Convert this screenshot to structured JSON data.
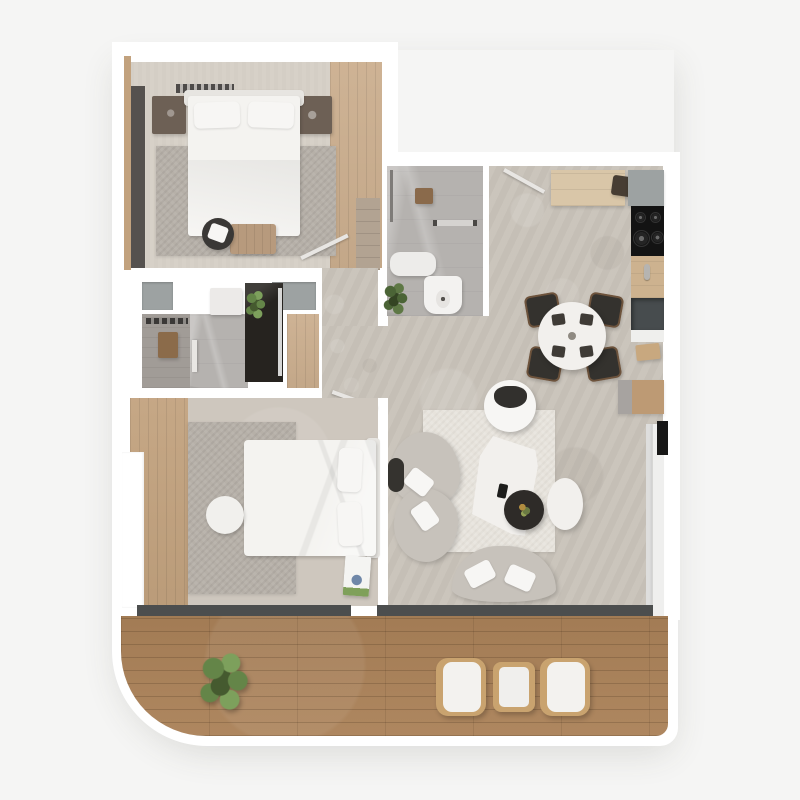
{
  "scene": {
    "title": "Two-bedroom apartment with balcony – 3D floor plan, top view",
    "style": "photoreal architectural render, no text labels"
  },
  "palette": {
    "bg": "#f5f5f4",
    "wall": "#ffffff",
    "concrete": "#c9c3ba",
    "carpet": "#d7d1c8",
    "rugGray": "#b6b0a8",
    "rugCream": "#e7e3dc",
    "woodCloset": "#cbae8e",
    "woodStrip": "#c2a27e",
    "deck": "#ab8259",
    "tileGray": "#b5b2af",
    "tileVanity": "#a19c97",
    "showerDark": "#26231f",
    "panelGray": "#9da2a2",
    "counterWood": "#d9c6a8",
    "counterWoodDark": "#cdb28f",
    "cooktop": "#131313",
    "sinkDark": "#474c4e",
    "applianceDark": "#473d33",
    "chairDark": "#34322e",
    "chairTrim": "#9c7049",
    "tableWhite": "#f2f0ed",
    "sofaGray": "#c7c2bb",
    "cushionWhite": "#f7f6f4",
    "sill": "#4c4e4e",
    "plantLight": "#7da05c",
    "plantMid": "#648548",
    "plantDark": "#455a2f",
    "towel": "#8b6b4a",
    "matBrown": "#8a6a4b",
    "wardrobe": "#55514e",
    "nightstand": "#6d6055",
    "bedWhite": "#f4f3f0",
    "headboard": "#e7e5e1",
    "doorLeaf": "#e8e6e3",
    "glass": "#ebebea",
    "black": "#171717",
    "tan": "#bd9a74"
  },
  "rooms": [
    {
      "id": "bedroom-1",
      "label": "Bedroom 1",
      "furniture": [
        "double-bed",
        "nightstand-left",
        "nightstand-right",
        "rug",
        "round-stool",
        "bench",
        "wardrobe",
        "radiator",
        "shelf-unit"
      ]
    },
    {
      "id": "bathroom-1",
      "label": "Bathroom 1",
      "furniture": [
        "walk-in-shower",
        "bath-mat",
        "towel-rail",
        "shower-tray",
        "toilet",
        "plant"
      ]
    },
    {
      "id": "bathroom-2",
      "label": "Bathroom 2",
      "furniture": [
        "vanity",
        "towel-rail",
        "towel",
        "sink-unit",
        "shower-cabin",
        "glass-screen",
        "plant",
        "wood-floor-nook"
      ]
    },
    {
      "id": "hallway",
      "label": "Hallway",
      "furniture": [
        "door-to-bedroom-1",
        "door-to-bedroom-2",
        "bathroom-door"
      ]
    },
    {
      "id": "kitchen",
      "label": "Kitchen",
      "furniture": [
        "top-counter",
        "small-appliance",
        "corner-cabinet",
        "cooktop",
        "counter",
        "faucet",
        "sink",
        "base-cabinet",
        "stool"
      ]
    },
    {
      "id": "dining-area",
      "label": "Dining area",
      "furniture": [
        "round-table",
        "chair-nw",
        "chair-ne",
        "chair-sw",
        "chair-se",
        "entry-door"
      ]
    },
    {
      "id": "living-room",
      "label": "Living room",
      "furniture": [
        "armchair",
        "curved-sofa-left",
        "curved-sofa-bottom",
        "coffee-table",
        "round-side-table",
        "oval-side-table",
        "rug",
        "console",
        "sliding-door",
        "remote"
      ]
    },
    {
      "id": "bedroom-2",
      "label": "Bedroom 2",
      "furniture": [
        "double-bed",
        "pouf",
        "rug",
        "magazine",
        "window-bay"
      ]
    },
    {
      "id": "balcony",
      "label": "Balcony",
      "furniture": [
        "plant",
        "lounge-chair-left",
        "side-table",
        "lounge-chair-right"
      ]
    }
  ],
  "windows": [
    "bedroom-2-south-window",
    "living-room-south-window",
    "living-room-east-sliding-door"
  ]
}
